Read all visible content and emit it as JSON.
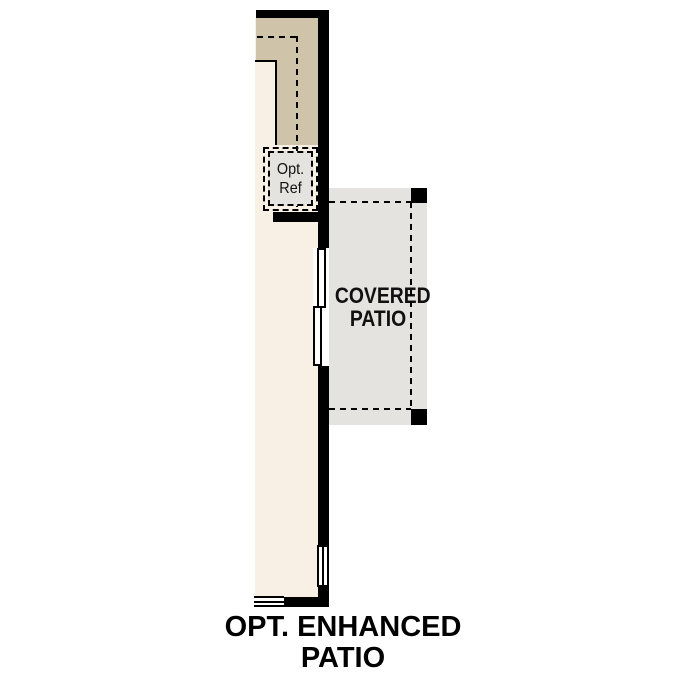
{
  "plan_title": "OPT. ENHANCED PATIO",
  "rooms": {
    "covered_patio": {
      "label": "COVERED PATIO"
    },
    "opt_ref": {
      "label": "Opt. Ref"
    }
  },
  "colors": {
    "background": "#ffffff",
    "wall_black": "#000000",
    "interior_cream": "#f8f0e5",
    "counter_tan": "#cfc3aa",
    "patio_gray": "#e4e3e0",
    "ref_gray": "#e4e3e0"
  }
}
